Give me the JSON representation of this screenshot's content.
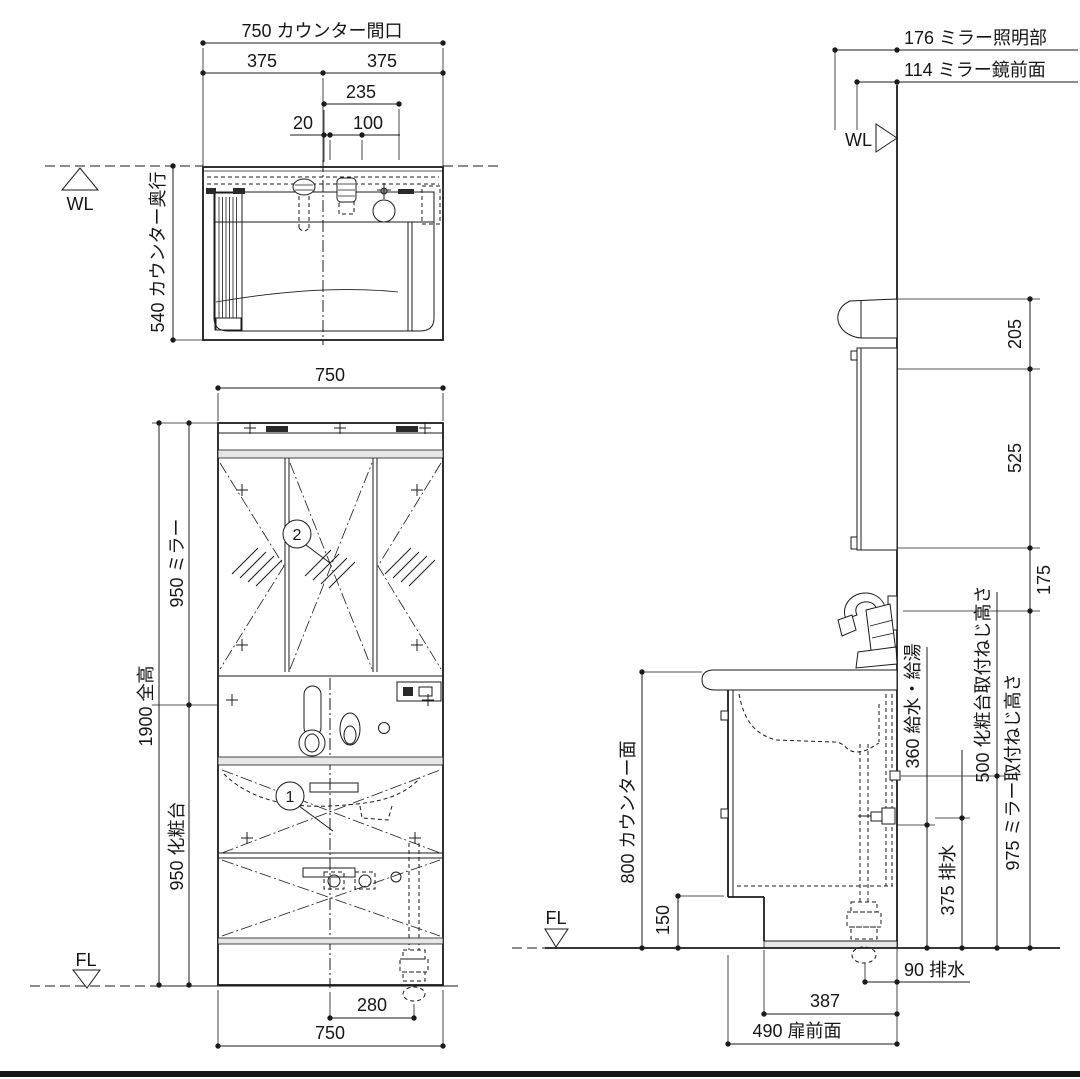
{
  "plan_view": {
    "dim_counter_width": "750 カウンター間口",
    "dim_left_half": "375",
    "dim_right_half": "375",
    "dim_235": "235",
    "dim_20": "20",
    "dim_100": "100",
    "dim_counter_depth": "540 カウンター奥行",
    "wl_label": "WL"
  },
  "front_view": {
    "dim_width_top": "750",
    "dim_total_height": "1900 全高",
    "dim_mirror_height": "950 ミラー",
    "dim_vanity_height": "950 化粧台",
    "dim_drain_offset": "280",
    "dim_width_bottom": "750",
    "fl_label": "FL",
    "callout_mirror": "2",
    "callout_vanity": "1"
  },
  "side_view": {
    "dim_light_depth": "176 ミラー照明部",
    "dim_mirror_face_depth": "114 ミラー鏡前面",
    "wl_label": "WL",
    "dim_205": "205",
    "dim_525": "525",
    "dim_175": "175",
    "dim_counter_height": "800 カウンター面",
    "dim_toe_kick": "150",
    "fl_label": "FL",
    "dim_supply_height": "360 給水・給湯",
    "dim_drain_height": "375 排水",
    "dim_vanity_screw_height": "500 化粧台取付ねじ高さ",
    "dim_mirror_screw_height": "975 ミラー取付ねじ高さ",
    "dim_drain_wall_offset": "90 排水",
    "dim_387": "387",
    "dim_door_face": "490 扉前面"
  }
}
